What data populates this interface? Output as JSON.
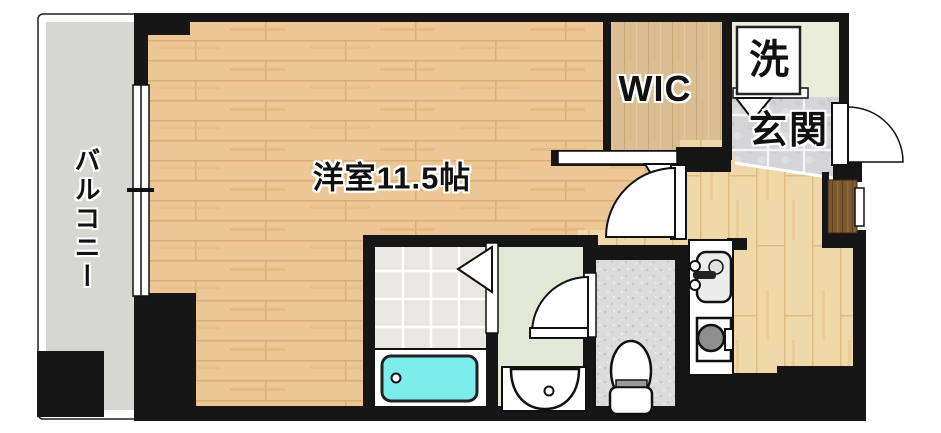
{
  "plan": {
    "labels": {
      "balcony": "バルコニー",
      "living_room": "洋室11.5帖",
      "wic": "WIC",
      "laundry": "洗",
      "entrance": "玄関"
    },
    "colors": {
      "wall": "#161616",
      "bathtub": "#7dedec",
      "room_floor": "#ecc795",
      "hall_floor": "#f1d8a9",
      "wic_floor": "#dabd90",
      "balcony_floor": "#d6d6d2",
      "entrance_tile": "#d5d5d8",
      "bathroom_tile": "#e9e7e1",
      "washroom_floor": "#e3e7d5",
      "laundry_floor": "#eaeeda",
      "toilet_floor": "#dcdcdc",
      "shoe_cabinet": "#7d5a2e"
    }
  }
}
